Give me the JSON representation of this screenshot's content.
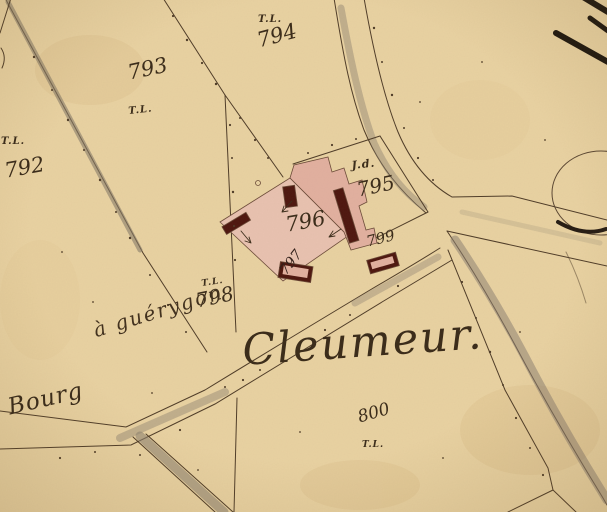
{
  "labels": {
    "section_title": "Cleumeur.",
    "road_name": "à guérygon",
    "hamlet": "Bourg",
    "parcels": [
      {
        "number": "792",
        "note": "T.L."
      },
      {
        "number": "793",
        "note": "T.L."
      },
      {
        "number": "794",
        "note": "T.L."
      },
      {
        "number": "795",
        "note": "J.d."
      },
      {
        "number": "796"
      },
      {
        "number": "797"
      },
      {
        "number": "798",
        "note": "T.L."
      },
      {
        "number": "799"
      },
      {
        "number": "800",
        "note": "T.L."
      }
    ]
  },
  "colors": {
    "paper": "#e9d2a2",
    "ink": "#3c2d1b",
    "boundary_line": "#4e3b27",
    "building_courtyard_pink": "#e9c2b1",
    "building_pink": "#e2b0a0",
    "building_dark_red": "#4d150e",
    "road_shade_gray": "#8e8272"
  }
}
